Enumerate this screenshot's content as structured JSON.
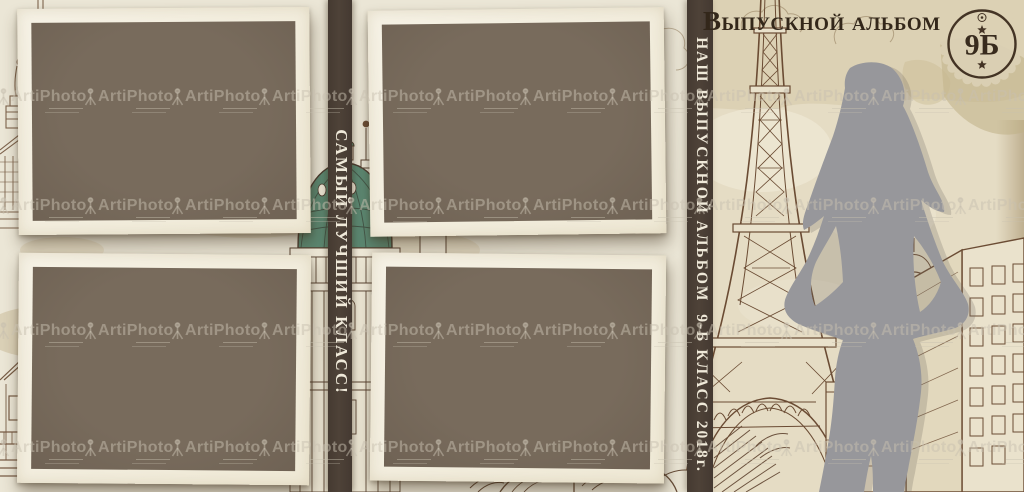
{
  "album": {
    "title": "Выпускной альбом",
    "badge_text": "9Б",
    "spine_caption": "САМЫЙ ЛУЧШИЙ КЛАСС!",
    "cover_caption": "НАШ ВЫПУСКНОЙ АЛЬБОМ  9-Б КЛАСС 2018г."
  },
  "watermark": {
    "brand": "ArtiPhoto",
    "icon": "camera-tripod-icon"
  },
  "photo_slots": [
    "photo-slot-1",
    "photo-slot-2",
    "photo-slot-3",
    "photo-slot-4"
  ],
  "scene": {
    "left_page_art": [
      "classic-buildings-sketch",
      "karlskirche-dome-sketch",
      "house-sketch",
      "open-book-sketch"
    ],
    "right_page_art": [
      "eiffel-tower-sketch",
      "city-buildings-sketch",
      "woman-silhouette"
    ]
  },
  "colors": {
    "page_cream": "#ebe6d6",
    "page_tan": "#ddd2b6",
    "frame_border": "#f4f0e2",
    "photo_placeholder": "#746758",
    "strip_brown": "#4a3e35",
    "ink": "#33271a",
    "sketch_sepia": "#6b4e36",
    "dome_green": "#5c8872",
    "silhouette_gray": "#98989a"
  }
}
